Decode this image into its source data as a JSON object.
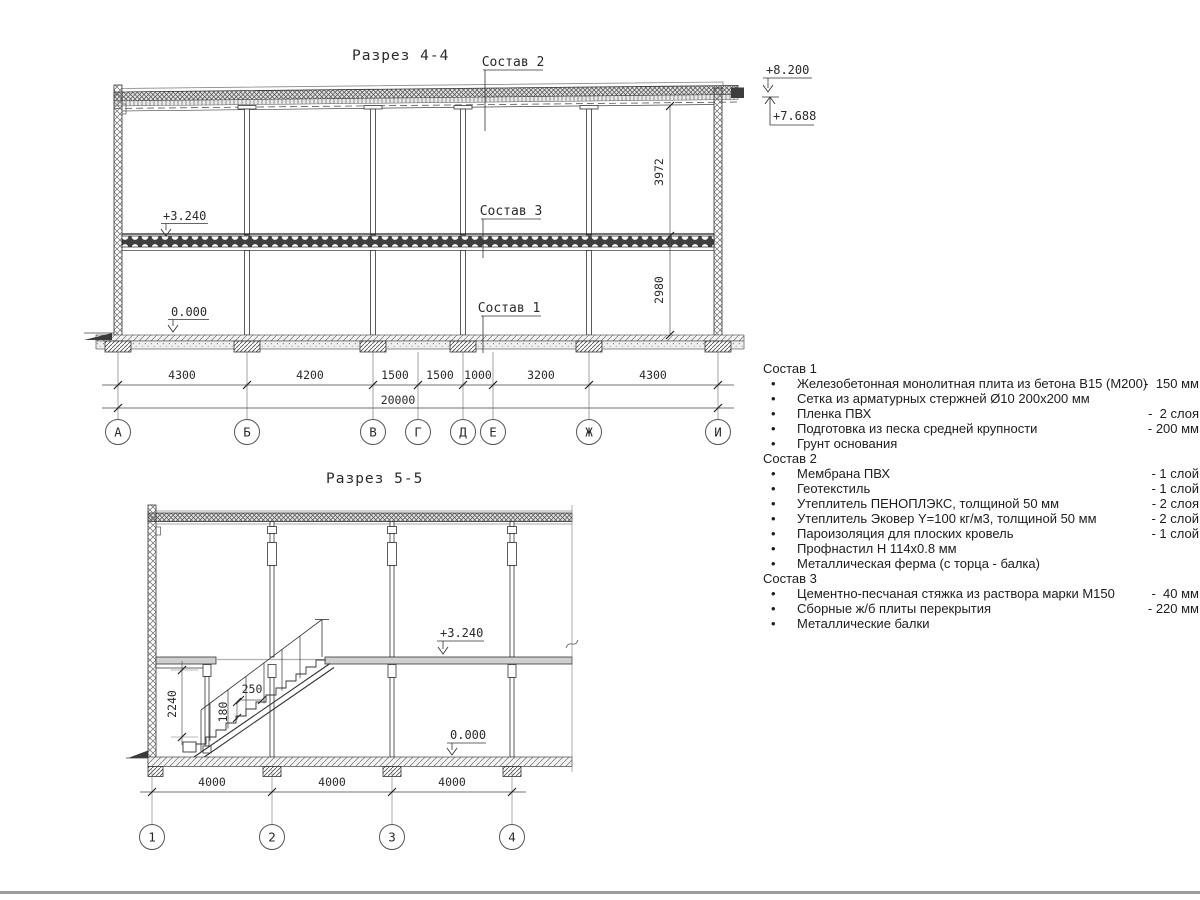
{
  "section44": {
    "title": "Разрез 4-4",
    "callouts": {
      "sostav2": "Состав 2",
      "sostav3": "Состав 3",
      "sostav1": "Состав 1"
    },
    "elevations": {
      "roof_top": "+8.200",
      "roof_low": "+7.688",
      "floor": "+3.240",
      "ground": "0.000"
    },
    "vdims": {
      "upper": "3972",
      "lower": "2980"
    },
    "hdims": [
      "4300",
      "4200",
      "1500",
      "1500",
      "1000",
      "3200",
      "4300"
    ],
    "total": "20000",
    "axes": [
      "А",
      "Б",
      "В",
      "Г",
      "Д",
      "Е",
      "Ж",
      "И"
    ]
  },
  "section55": {
    "title": "Разрез 5-5",
    "elevations": {
      "floor": "+3.240",
      "ground": "0.000"
    },
    "stair_dims": {
      "height": "2240",
      "tread": "250",
      "riser": "180"
    },
    "hdims": [
      "4000",
      "4000",
      "4000"
    ],
    "axes": [
      "1",
      "2",
      "3",
      "4"
    ]
  },
  "specs": [
    {
      "heading": "Состав 1",
      "items": [
        {
          "text": "Железобетонная монолитная плита из бетона В15 (М200)",
          "qty": "-  150 мм"
        },
        {
          "text": "Сетка из арматурных стержней Ø10 200x200 мм",
          "qty": ""
        },
        {
          "text": "Пленка ПВХ",
          "qty": "-  2 слоя"
        },
        {
          "text": "Подготовка из песка средней крупности",
          "qty": "- 200 мм"
        },
        {
          "text": "Грунт основания",
          "qty": ""
        }
      ]
    },
    {
      "heading": "Состав 2",
      "items": [
        {
          "text": "Мембрана ПВХ",
          "qty": "- 1 слой"
        },
        {
          "text": "Геотекстиль",
          "qty": "- 1 слой"
        },
        {
          "text": "Утеплитель ПЕНОПЛЭКС, толщиной 50 мм",
          "qty": "- 2 слоя"
        },
        {
          "text": "Утеплитель Эковер Y=100 кг/м3, толщиной 50 мм",
          "qty": "- 2 слой"
        },
        {
          "text": "Пароизоляция для плоских кровель",
          "qty": "- 1 слой"
        },
        {
          "text": "Профнастил Н 114x0.8 мм",
          "qty": ""
        },
        {
          "text": "Металлическая ферма (с торца - балка)",
          "qty": ""
        }
      ]
    },
    {
      "heading": "Состав 3",
      "items": [
        {
          "text": "Цементно-песчаная стяжка из раствора марки М150",
          "qty": "-  40 мм"
        },
        {
          "text": "Сборные ж/б плиты перекрытия",
          "qty": "- 220 мм"
        },
        {
          "text": "Металлические балки",
          "qty": ""
        }
      ]
    }
  ]
}
